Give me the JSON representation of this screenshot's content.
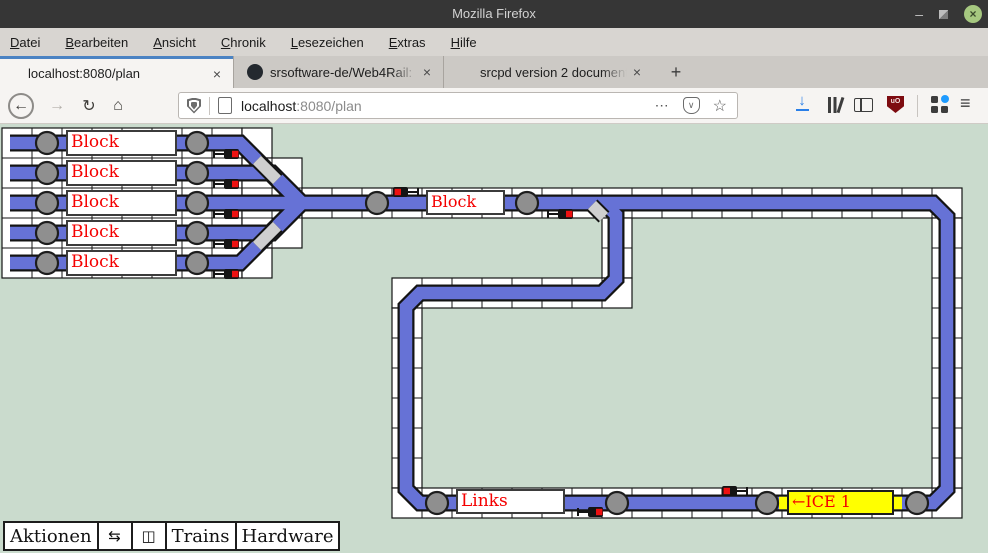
{
  "window": {
    "title": "Mozilla Firefox",
    "minimize": "–",
    "close": "×"
  },
  "menubar": {
    "items": [
      "Datei",
      "Bearbeiten",
      "Ansicht",
      "Chronik",
      "Lesezeichen",
      "Extras",
      "Hilfe"
    ]
  },
  "tabs": {
    "active_title": "localhost:8080/plan",
    "tab2_title": "srsoftware-de/Web4Rail: B",
    "tab3_title": "srcpd version 2 documenta",
    "close_glyph": "×",
    "new_tab_glyph": "+"
  },
  "navbar": {
    "back_glyph": "←",
    "forward_glyph": "→",
    "reload_glyph": "↻",
    "home_glyph": "⌂",
    "url_host": "localhost",
    "url_rest": ":8080/plan",
    "page_actions_glyph": "⋯",
    "pocket_glyph": "∨",
    "bookmark_glyph": "☆",
    "download_glyph": "↓",
    "menu_glyph": "≡",
    "ublock_text": "uO"
  },
  "plan": {
    "yard_blocks": [
      "Block",
      "Block",
      "Block",
      "Block",
      "Block"
    ],
    "main_block": "Block",
    "links_block": "Links",
    "train_label": "←ICE 1",
    "colors": {
      "track": "#6672d6",
      "occupied": "#ffff00",
      "label_text": "#f40000",
      "background": "#cadbcd",
      "accent_tab": "#4b83c3"
    }
  },
  "toolbar": {
    "buttons": [
      {
        "label": "Aktionen"
      },
      {
        "icon": "⇆"
      },
      {
        "icon": "◫"
      },
      {
        "label": "Trains"
      },
      {
        "label": "Hardware"
      }
    ]
  }
}
